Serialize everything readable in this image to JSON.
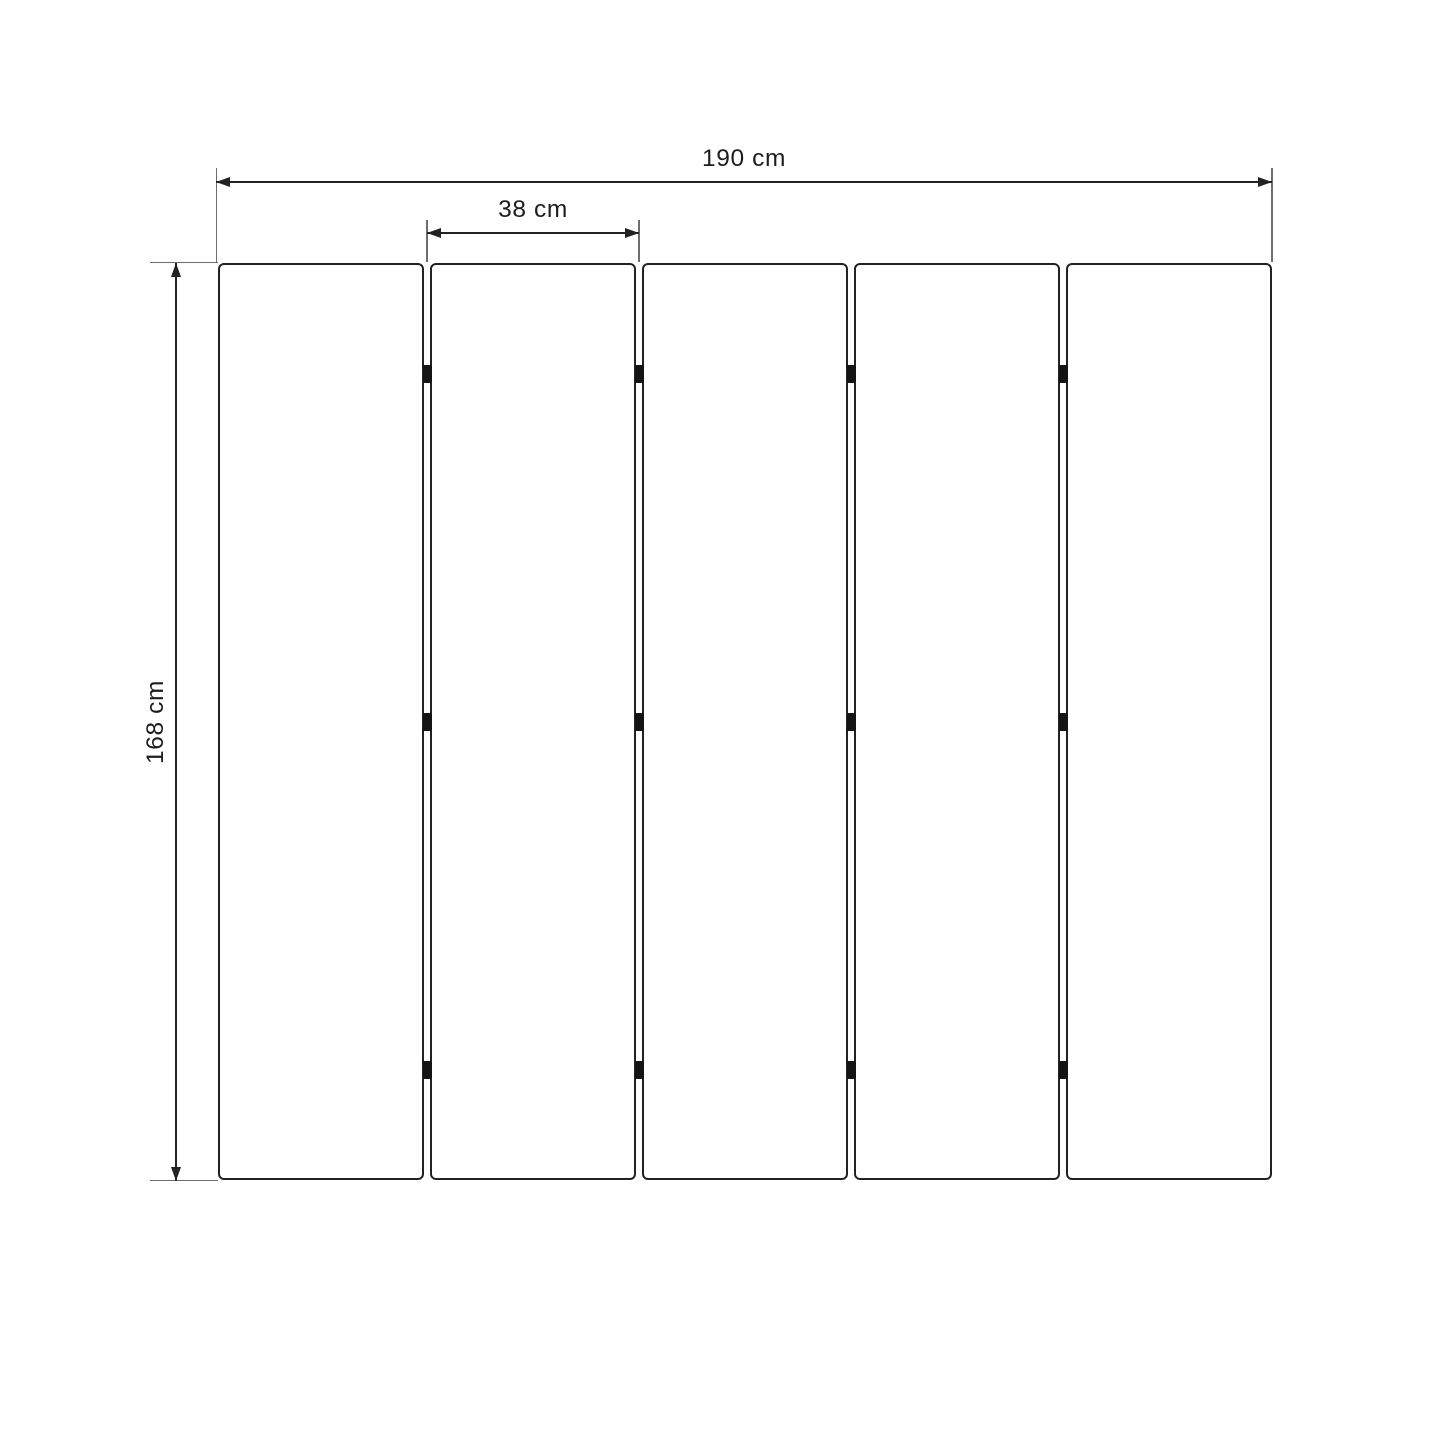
{
  "diagram": {
    "type": "folding-screen-dimension-drawing",
    "panel_count": 5,
    "hinge_rows": 3,
    "dimensions": {
      "total_width": {
        "label": "190 cm"
      },
      "panel_width": {
        "label": "38 cm"
      },
      "height": {
        "label": "168 cm"
      }
    },
    "colors": {
      "line": "#222222",
      "extension_line": "#6e6e6e",
      "hinge": "#141414",
      "text": "#1d1d1d",
      "background": "#ffffff"
    }
  }
}
